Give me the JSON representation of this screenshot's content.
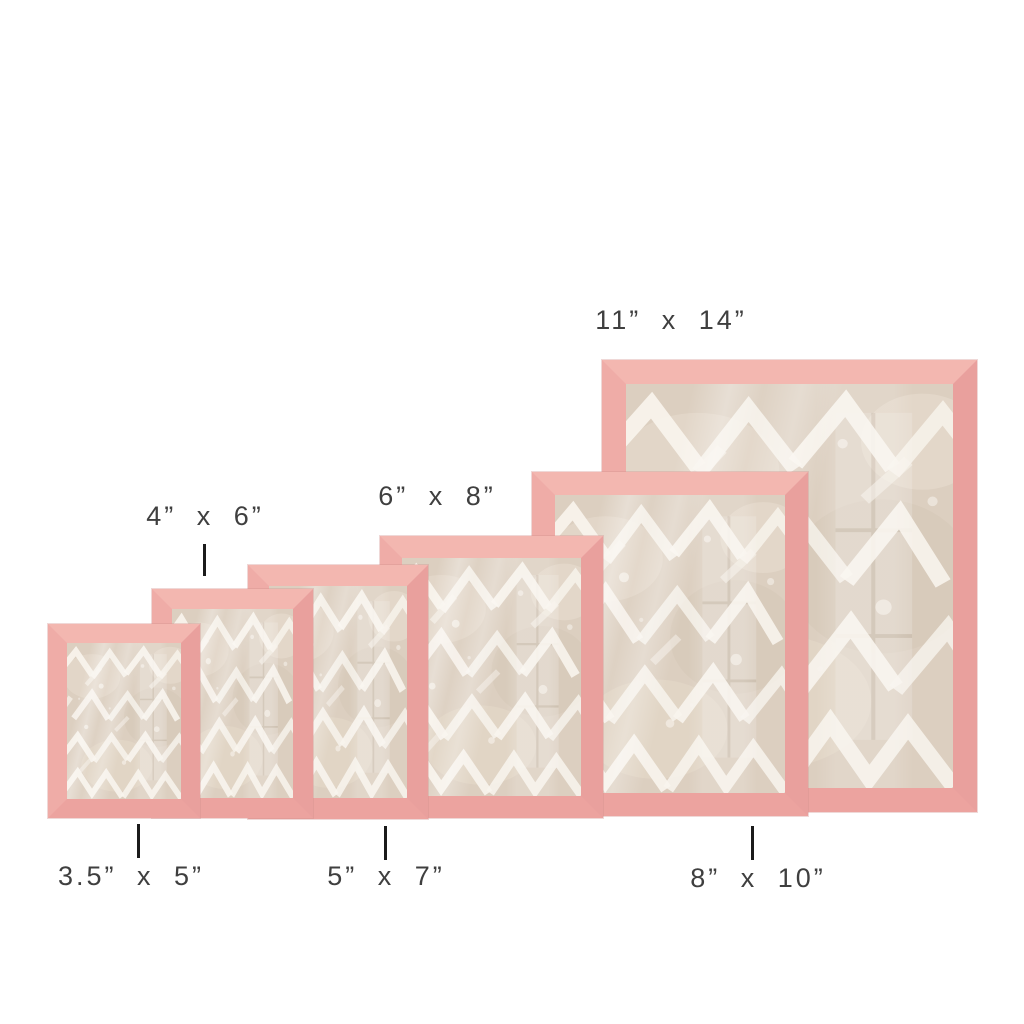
{
  "image": {
    "type": "product-size-comparison",
    "background_color": "#ffffff",
    "frame_color": "#eda6a2",
    "frame_highlight_color": "#f3b7b0",
    "frame_shadow_color": "#d68f8f",
    "art_background_color": "#dccfc0",
    "art_stroke_color": "#f8f4ed",
    "art_pattern": "white chevron brushstroke painting behind glass",
    "label_color": "#3f3f3f",
    "tick_color": "#1b1b1b",
    "frames": [
      {
        "id": "3-5x5",
        "size_label": "3.5” x 5”",
        "label_position": "bottom"
      },
      {
        "id": "4x6",
        "size_label": "4” x 6”",
        "label_position": "top"
      },
      {
        "id": "5x7",
        "size_label": "5” x 7”",
        "label_position": "bottom"
      },
      {
        "id": "6x8",
        "size_label": "6” x 8”",
        "label_position": "top"
      },
      {
        "id": "8x10",
        "size_label": "8” x 10”",
        "label_position": "bottom"
      },
      {
        "id": "11x14",
        "size_label": "11” x 14”",
        "label_position": "top"
      }
    ]
  }
}
